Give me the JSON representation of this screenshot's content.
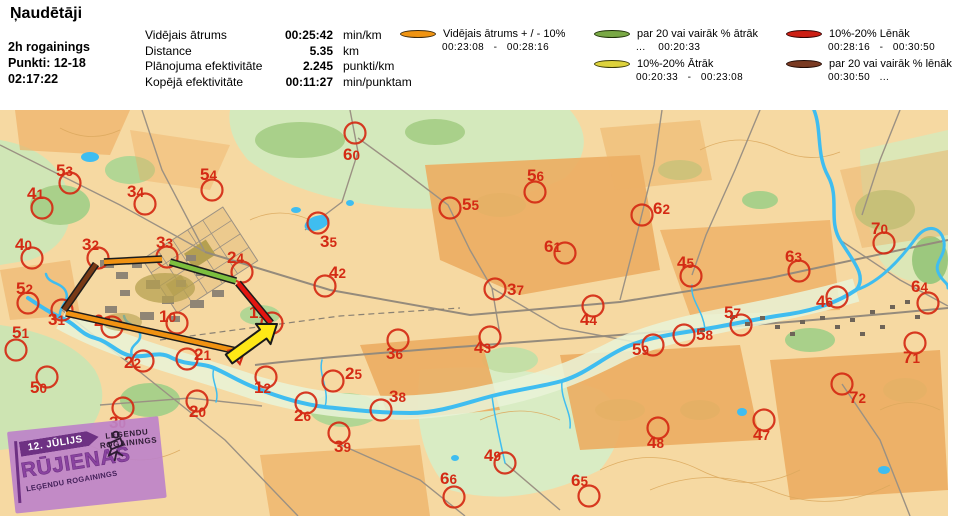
{
  "title": "Ņaudētāji",
  "info": {
    "line1": "2h rogainings",
    "line2": "Punkti: 12-18",
    "line3": "02:17:22"
  },
  "stats": {
    "rows": [
      {
        "label": "Vidējais ātrums",
        "value": "00:25:42",
        "unit": "min/km"
      },
      {
        "label": "Distance",
        "value": "5.35",
        "unit": "km"
      },
      {
        "label": "Plānojuma efektivitāte",
        "value": "2.245",
        "unit": "punkti/km"
      },
      {
        "label": "Kopējā efektivitāte",
        "value": "00:11:27",
        "unit": "min/punktam"
      }
    ]
  },
  "legend": {
    "items": [
      {
        "id": "avg",
        "col": 1,
        "color": "#ef9413",
        "outline": "#3a2a10",
        "label": "Vidējais ātrums + / - 10%",
        "range": "00:23:08   -   00:28:16"
      },
      {
        "id": "fast20",
        "col": 2,
        "color": "#79a845",
        "outline": "#1e3008",
        "label": "par 20 vai vairāk % ātrāk",
        "range": "...    00:20:33"
      },
      {
        "id": "fast10",
        "col": 2,
        "color": "#ddd23c",
        "outline": "#3a3a08",
        "label": "10%-20% Ātrāk",
        "range": "00:20:33   -   00:23:08"
      },
      {
        "id": "slow10",
        "col": 3,
        "color": "#cc1f14",
        "outline": "#300404",
        "label": "10%-20% Lēnāk",
        "range": "00:28:16   -   00:30:50"
      },
      {
        "id": "slow20",
        "col": 3,
        "color": "#7a3a22",
        "outline": "#200a04",
        "label": "par 20 vai vairāk % lēnāk",
        "range": "00:30:50   ..."
      }
    ]
  },
  "map": {
    "control_color": "#d42a14",
    "controls": [
      {
        "n": "53",
        "cx": 70,
        "cy": 73,
        "lx": 56,
        "ly": 66
      },
      {
        "n": "41",
        "cx": 42,
        "cy": 98,
        "lx": 27,
        "ly": 89
      },
      {
        "n": "34",
        "cx": 145,
        "cy": 94,
        "lx": 127,
        "ly": 87
      },
      {
        "n": "54",
        "cx": 212,
        "cy": 80,
        "lx": 200,
        "ly": 70
      },
      {
        "n": "60",
        "cx": 355,
        "cy": 23,
        "lx": 343,
        "ly": 50
      },
      {
        "n": "35",
        "cx": 318,
        "cy": 113,
        "lx": 320,
        "ly": 137
      },
      {
        "n": "55",
        "cx": 450,
        "cy": 98,
        "lx": 462,
        "ly": 100
      },
      {
        "n": "56",
        "cx": 535,
        "cy": 82,
        "lx": 527,
        "ly": 71
      },
      {
        "n": "62",
        "cx": 642,
        "cy": 105,
        "lx": 653,
        "ly": 104
      },
      {
        "n": "70",
        "cx": 884,
        "cy": 133,
        "lx": 871,
        "ly": 124
      },
      {
        "n": "45",
        "cx": 691,
        "cy": 166,
        "lx": 677,
        "ly": 158
      },
      {
        "n": "63",
        "cx": 799,
        "cy": 161,
        "lx": 785,
        "ly": 152
      },
      {
        "n": "64",
        "cx": 928,
        "cy": 193,
        "lx": 911,
        "ly": 182
      },
      {
        "n": "40",
        "cx": 32,
        "cy": 148,
        "lx": 15,
        "ly": 140
      },
      {
        "n": "32",
        "cx": 98,
        "cy": 148,
        "lx": 82,
        "ly": 140
      },
      {
        "n": "33",
        "cx": 167,
        "cy": 147,
        "lx": 156,
        "ly": 138
      },
      {
        "n": "24",
        "cx": 242,
        "cy": 162,
        "lx": 227,
        "ly": 153
      },
      {
        "n": "42",
        "cx": 325,
        "cy": 176,
        "lx": 329,
        "ly": 168
      },
      {
        "n": "61",
        "cx": 565,
        "cy": 143,
        "lx": 544,
        "ly": 142
      },
      {
        "n": "44",
        "cx": 593,
        "cy": 196,
        "lx": 580,
        "ly": 215
      },
      {
        "n": "43",
        "cx": 490,
        "cy": 227,
        "lx": 474,
        "ly": 243
      },
      {
        "n": "37",
        "cx": 495,
        "cy": 179,
        "lx": 507,
        "ly": 185
      },
      {
        "n": "52",
        "cx": 28,
        "cy": 193,
        "lx": 16,
        "ly": 184
      },
      {
        "n": "31",
        "cx": 62,
        "cy": 200,
        "lx": 48,
        "ly": 215
      },
      {
        "n": "23",
        "cx": 112,
        "cy": 217,
        "lx": 94,
        "ly": 216
      },
      {
        "n": "10",
        "cx": 177,
        "cy": 213,
        "lx": 159,
        "ly": 212
      },
      {
        "n": "11",
        "cx": 272,
        "cy": 213,
        "lx": 249,
        "ly": 208
      },
      {
        "n": "51",
        "cx": 16,
        "cy": 240,
        "lx": 12,
        "ly": 228
      },
      {
        "n": "22",
        "cx": 143,
        "cy": 251,
        "lx": 124,
        "ly": 258
      },
      {
        "n": "21",
        "cx": 187,
        "cy": 249,
        "lx": 194,
        "ly": 250
      },
      {
        "n": "50",
        "cx": 47,
        "cy": 267,
        "lx": 30,
        "ly": 283
      },
      {
        "n": "30",
        "cx": 123,
        "cy": 298,
        "lx": 109,
        "ly": 318
      },
      {
        "n": "20",
        "cx": 197,
        "cy": 291,
        "lx": 189,
        "ly": 307
      },
      {
        "n": "12",
        "cx": 266,
        "cy": 267,
        "lx": 254,
        "ly": 283
      },
      {
        "n": "26",
        "cx": 306,
        "cy": 293,
        "lx": 294,
        "ly": 311
      },
      {
        "n": "25",
        "cx": 333,
        "cy": 271,
        "lx": 345,
        "ly": 269
      },
      {
        "n": "38",
        "cx": 381,
        "cy": 300,
        "lx": 389,
        "ly": 292
      },
      {
        "n": "39",
        "cx": 339,
        "cy": 323,
        "lx": 334,
        "ly": 342
      },
      {
        "n": "36",
        "cx": 398,
        "cy": 230,
        "lx": 386,
        "ly": 249
      },
      {
        "n": "66",
        "cx": 454,
        "cy": 387,
        "lx": 440,
        "ly": 374
      },
      {
        "n": "49",
        "cx": 505,
        "cy": 353,
        "lx": 484,
        "ly": 351
      },
      {
        "n": "65",
        "cx": 589,
        "cy": 386,
        "lx": 571,
        "ly": 376
      },
      {
        "n": "48",
        "cx": 658,
        "cy": 318,
        "lx": 647,
        "ly": 338
      },
      {
        "n": "47",
        "cx": 764,
        "cy": 310,
        "lx": 753,
        "ly": 330
      },
      {
        "n": "72",
        "cx": 842,
        "cy": 274,
        "lx": 849,
        "ly": 293
      },
      {
        "n": "71",
        "cx": 915,
        "cy": 233,
        "lx": 903,
        "ly": 253
      },
      {
        "n": "57",
        "cx": 741,
        "cy": 215,
        "lx": 724,
        "ly": 208
      },
      {
        "n": "58",
        "cx": 684,
        "cy": 225,
        "lx": 696,
        "ly": 230
      },
      {
        "n": "59",
        "cx": 653,
        "cy": 235,
        "lx": 632,
        "ly": 245
      },
      {
        "n": "46",
        "cx": 837,
        "cy": 187,
        "lx": 816,
        "ly": 197
      }
    ],
    "segment_colors": {
      "avg": "#f09212",
      "fast20": "#7cbf3e",
      "fast10": "#ddd23c",
      "slow10": "#e31510",
      "slow20": "#7a3a16"
    },
    "route_segments": [
      {
        "kind": "avg",
        "from": "start",
        "to": "31",
        "x1": 237,
        "y1": 241,
        "x2": 66,
        "y2": 203
      },
      {
        "kind": "slow20",
        "from": "31",
        "to": "32",
        "x1": 64,
        "y1": 200,
        "x2": 96,
        "y2": 154
      },
      {
        "kind": "avg",
        "from": "32",
        "to": "33",
        "x1": 104,
        "y1": 152,
        "x2": 162,
        "y2": 149
      },
      {
        "kind": "fast20",
        "from": "33",
        "to": "24",
        "x1": 170,
        "y1": 152,
        "x2": 236,
        "y2": 171
      },
      {
        "kind": "slow10",
        "from": "24",
        "to": "11",
        "x1": 238,
        "y1": 173,
        "x2": 271,
        "y2": 213
      }
    ],
    "arrow": {
      "color": "#ffe816",
      "outline": "#1a1a1a",
      "tail_x": 229,
      "tail_y": 249,
      "head_x": 277,
      "head_y": 214
    },
    "start_triangle": {
      "cx": 238,
      "cy": 244,
      "r": 10
    }
  },
  "logo": {
    "date": "12. JŪLIJS",
    "title": "RŪJIENAS",
    "subtitle": "LEĢENDU ROGAININGS",
    "badge_line1": "LEĢENDU",
    "badge_line2": "ROGAININGS"
  }
}
